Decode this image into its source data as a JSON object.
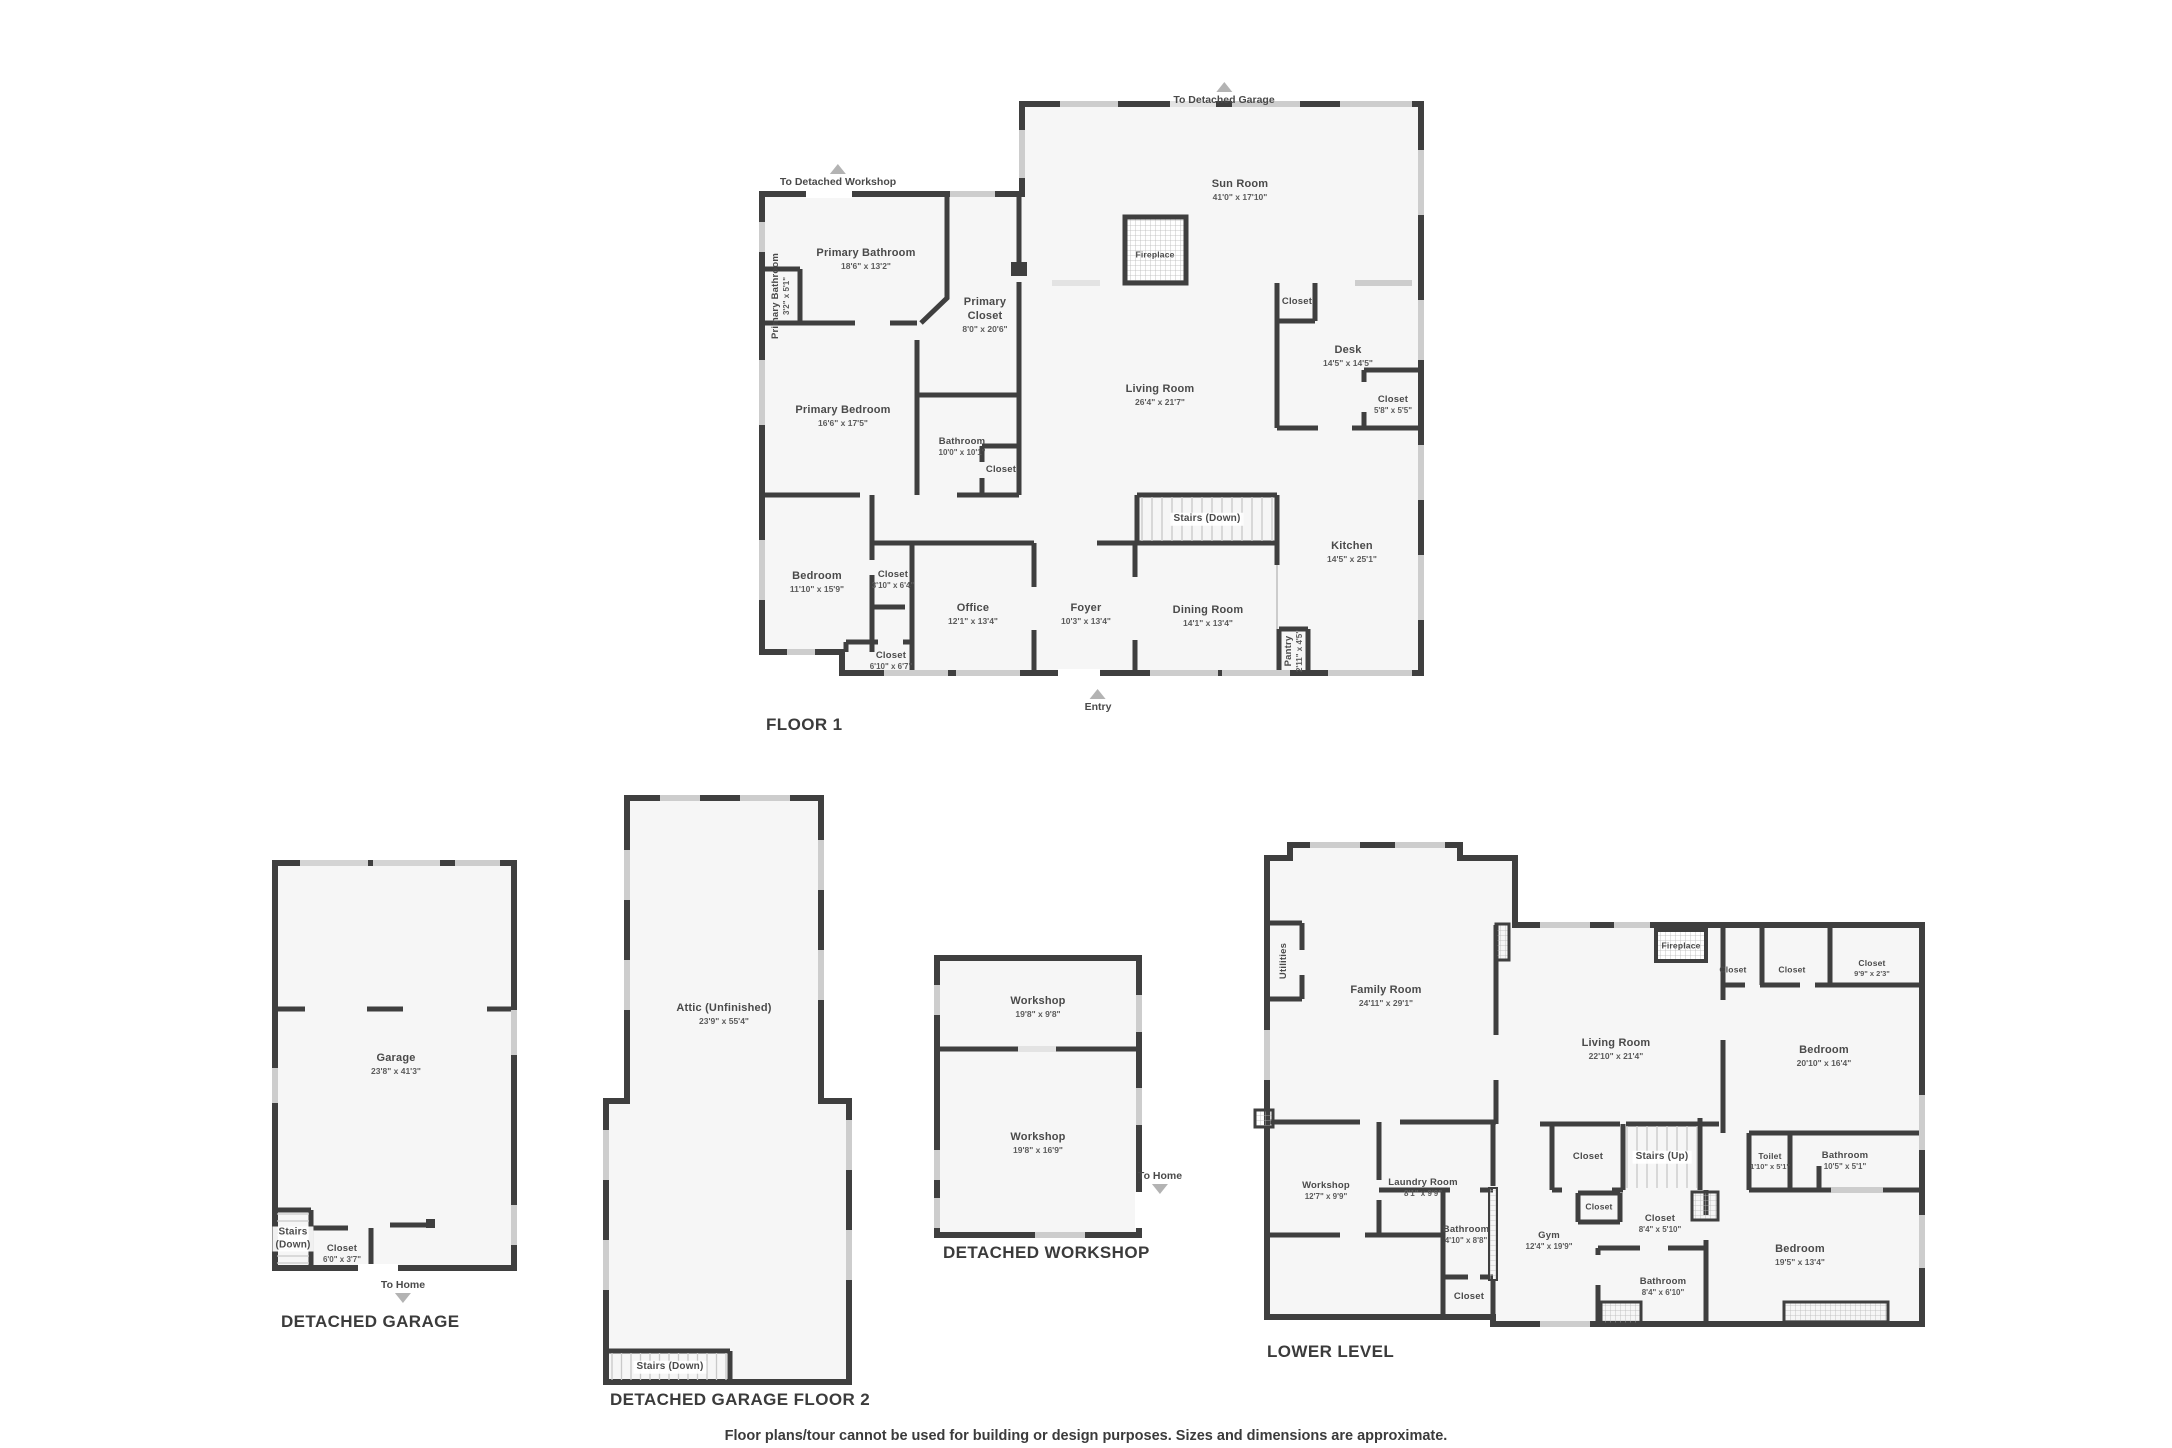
{
  "page": {
    "footer": "Floor plans/tour cannot be used for building or design purposes. Sizes and dimensions are approximate.",
    "wall_color": "#3f3f3f",
    "floor_color": "#f6f6f6",
    "window_color": "#cdcdcd",
    "arrow_color": "#b3b3b3"
  },
  "plans": [
    {
      "id": "floor-1",
      "title": "FLOOR 1",
      "title_pos": {
        "x": 766,
        "y": 715
      },
      "rooms": [
        {
          "name": "Sun Room",
          "dims": "41'0\" x 17'10\"",
          "x": 1240,
          "y": 190
        },
        {
          "name": "Fireplace",
          "x": 1155,
          "y": 255,
          "size": "xs"
        },
        {
          "name": "Primary Bathroom",
          "dims": "18'6\" x 13'2\"",
          "x": 866,
          "y": 259
        },
        {
          "name": "Primary Bathroom",
          "dims": "3'2\" x 5'1\"",
          "x": 781,
          "y": 296,
          "rot": true,
          "size": "sm"
        },
        {
          "name": "Primary\nCloset",
          "dims": "8'0\" x 20'6\"",
          "x": 985,
          "y": 315
        },
        {
          "name": "Living Room",
          "dims": "26'4\" x 21'7\"",
          "x": 1160,
          "y": 395
        },
        {
          "name": "Closet",
          "x": 1297,
          "y": 302,
          "size": "sm"
        },
        {
          "name": "Desk",
          "dims": "14'5\" x 14'5\"",
          "x": 1348,
          "y": 356
        },
        {
          "name": "Closet",
          "dims": "5'8\" x 5'5\"",
          "x": 1393,
          "y": 405,
          "size": "sm"
        },
        {
          "name": "Primary Bedroom",
          "dims": "16'6\" x 17'5\"",
          "x": 843,
          "y": 416
        },
        {
          "name": "Bathroom",
          "dims": "10'0\" x 10'1\"",
          "x": 962,
          "y": 447,
          "size": "sm"
        },
        {
          "name": "Closet",
          "x": 1001,
          "y": 470,
          "size": "sm"
        },
        {
          "name": "Stairs (Down)",
          "x": 1207,
          "y": 519,
          "size": "stairs"
        },
        {
          "name": "Kitchen",
          "dims": "14'5\" x 25'1\"",
          "x": 1352,
          "y": 552
        },
        {
          "name": "Bedroom",
          "dims": "11'10\" x 15'9\"",
          "x": 817,
          "y": 582
        },
        {
          "name": "Closet",
          "dims": "3'10\" x 6'4\"",
          "x": 893,
          "y": 580,
          "size": "sm"
        },
        {
          "name": "Office",
          "dims": "12'1\" x 13'4\"",
          "x": 973,
          "y": 614
        },
        {
          "name": "Foyer",
          "dims": "10'3\" x 13'4\"",
          "x": 1086,
          "y": 614
        },
        {
          "name": "Dining Room",
          "dims": "14'1\" x 13'4\"",
          "x": 1208,
          "y": 616
        },
        {
          "name": "Pantry",
          "dims": "2'11\" x 4'5\"",
          "x": 1294,
          "y": 651,
          "rot": true,
          "size": "sm"
        },
        {
          "name": "Closet",
          "dims": "6'10\" x 6'7\"",
          "x": 891,
          "y": 661,
          "size": "sm"
        }
      ],
      "nav": [
        {
          "label": "To Detached Garage",
          "x": 1224,
          "y": 93,
          "dir": "up"
        },
        {
          "label": "To Detached Workshop",
          "x": 838,
          "y": 175,
          "dir": "up"
        },
        {
          "label": "Entry",
          "x": 1098,
          "y": 700,
          "dir": "up"
        }
      ]
    },
    {
      "id": "detached-garage",
      "title": "DETACHED GARAGE",
      "title_pos": {
        "x": 281,
        "y": 1312
      },
      "rooms": [
        {
          "name": "Garage",
          "dims": "23'8\" x 41'3\"",
          "x": 396,
          "y": 1064
        },
        {
          "name": "Stairs\n(Down)",
          "x": 293,
          "y": 1239,
          "size": "stairs"
        },
        {
          "name": "Closet",
          "dims": "6'0\" x 3'7\"",
          "x": 342,
          "y": 1254,
          "size": "sm"
        }
      ],
      "nav": [
        {
          "label": "To Home",
          "x": 403,
          "y": 1292,
          "dir": "down"
        }
      ]
    },
    {
      "id": "detached-garage-floor-2",
      "title": "DETACHED GARAGE FLOOR 2",
      "title_pos": {
        "x": 610,
        "y": 1390
      },
      "rooms": [
        {
          "name": "Attic (Unfinished)",
          "dims": "23'9\" x 55'4\"",
          "x": 724,
          "y": 1014
        },
        {
          "name": "Stairs (Down)",
          "x": 670,
          "y": 1367,
          "size": "stairs"
        }
      ],
      "nav": []
    },
    {
      "id": "detached-workshop",
      "title": "DETACHED WORKSHOP",
      "title_pos": {
        "x": 943,
        "y": 1243
      },
      "rooms": [
        {
          "name": "Workshop",
          "dims": "19'8\" x 9'8\"",
          "x": 1038,
          "y": 1007
        },
        {
          "name": "Workshop",
          "dims": "19'8\" x 16'9\"",
          "x": 1038,
          "y": 1143
        }
      ],
      "nav": [
        {
          "label": "To Home",
          "x": 1160,
          "y": 1183,
          "dir": "down"
        }
      ]
    },
    {
      "id": "lower-level",
      "title": "LOWER LEVEL",
      "title_pos": {
        "x": 1267,
        "y": 1342
      },
      "rooms": [
        {
          "name": "Utilities",
          "x": 1284,
          "y": 961,
          "rot": true,
          "size": "sm"
        },
        {
          "name": "Family Room",
          "dims": "24'11\" x 29'1\"",
          "x": 1386,
          "y": 996
        },
        {
          "name": "Fireplace",
          "x": 1681,
          "y": 946,
          "size": "xs"
        },
        {
          "name": "Closet",
          "x": 1733,
          "y": 970,
          "size": "xs"
        },
        {
          "name": "Closet",
          "x": 1792,
          "y": 970,
          "size": "xs"
        },
        {
          "name": "Closet",
          "dims": "9'9\" x 2'3\"",
          "x": 1872,
          "y": 968,
          "size": "xs"
        },
        {
          "name": "Living Room",
          "dims": "22'10\" x 21'4\"",
          "x": 1616,
          "y": 1049
        },
        {
          "name": "Bedroom",
          "dims": "20'10\" x 16'4\"",
          "x": 1824,
          "y": 1056
        },
        {
          "name": "Workshop",
          "dims": "12'7\" x 9'9\"",
          "x": 1326,
          "y": 1191,
          "size": "sm"
        },
        {
          "name": "Laundry Room",
          "dims": "8'1\" x 9'9\"",
          "x": 1423,
          "y": 1188,
          "size": "sm"
        },
        {
          "name": "Bathroom",
          "dims": "4'10\" x 8'8\"",
          "x": 1466,
          "y": 1235,
          "size": "sm"
        },
        {
          "name": "Closet",
          "x": 1469,
          "y": 1297,
          "size": "sm"
        },
        {
          "name": "Gym",
          "dims": "12'4\" x 19'9\"",
          "x": 1549,
          "y": 1241,
          "size": "sm"
        },
        {
          "name": "Closet",
          "x": 1588,
          "y": 1157,
          "size": "sm"
        },
        {
          "name": "Stairs (Up)",
          "x": 1662,
          "y": 1157,
          "size": "stairs"
        },
        {
          "name": "Closet",
          "x": 1599,
          "y": 1207,
          "size": "xs"
        },
        {
          "name": "Closet",
          "dims": "8'4\" x 5'10\"",
          "x": 1660,
          "y": 1224,
          "size": "sm"
        },
        {
          "name": "Toilet",
          "dims": "1'10\" x 5'1\"",
          "x": 1770,
          "y": 1161,
          "size": "xs"
        },
        {
          "name": "Bathroom",
          "dims": "10'5\" x 5'1\"",
          "x": 1845,
          "y": 1161,
          "size": "sm"
        },
        {
          "name": "Bedroom",
          "dims": "19'5\" x 13'4\"",
          "x": 1800,
          "y": 1255
        },
        {
          "name": "Bathroom",
          "dims": "8'4\" x 6'10\"",
          "x": 1663,
          "y": 1287,
          "size": "sm"
        }
      ],
      "nav": []
    }
  ]
}
